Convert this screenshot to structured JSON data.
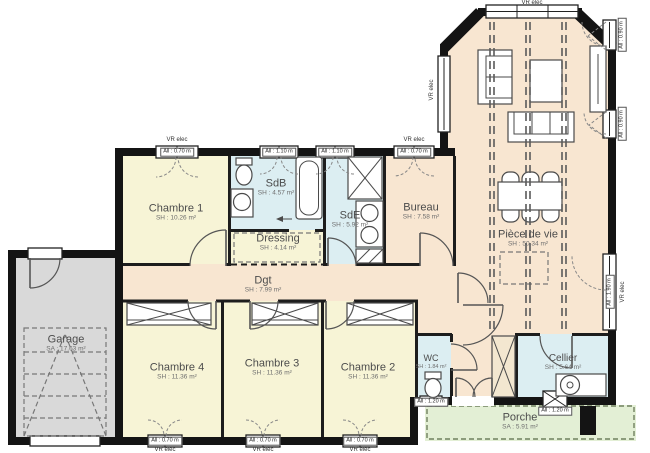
{
  "plan_title": "Plan de maison plain-pied",
  "colors": {
    "wall": "#141414",
    "bedroom_fill": "#f7f4d6",
    "wet_room_fill": "#dceef2",
    "living_fill": "#f8e6d1",
    "garage_fill": "#d9d9d9",
    "porch_fill": "#e3efd5"
  },
  "rooms": {
    "chambre1": {
      "name": "Chambre 1",
      "area": "SH : 10.26 m²"
    },
    "sdb": {
      "name": "SdB",
      "area": "SH : 4.57 m²"
    },
    "dressing": {
      "name": "Dressing",
      "area": "SH : 4.14 m²"
    },
    "sde": {
      "name": "SdE",
      "area": "SH : 5.92 m²"
    },
    "bureau": {
      "name": "Bureau",
      "area": "SH : 7.58 m²"
    },
    "piece_de_vie": {
      "name": "Pièce de vie",
      "area": "SH : 50.34 m²"
    },
    "dgt": {
      "name": "Dgt",
      "area": "SH : 7.99 m²"
    },
    "chambre4": {
      "name": "Chambre 4",
      "area": "SH : 11.36 m²"
    },
    "chambre3": {
      "name": "Chambre 3",
      "area": "SH : 11.36 m²"
    },
    "chambre2": {
      "name": "Chambre 2",
      "area": "SH : 11.36 m²"
    },
    "wc": {
      "name": "WC",
      "area": "SH : 1.84 m²"
    },
    "cellier": {
      "name": "Cellier",
      "area": "SH : 5.64 m²"
    },
    "porche": {
      "name": "Porche",
      "area": "SA : 5.91 m²"
    },
    "garage": {
      "name": "Garage",
      "area": "SA : 17.63 m²"
    }
  },
  "labels": {
    "vr": "VR elec",
    "top1": "All : 0.70 m",
    "top2": "All : 1.10 m",
    "top3": "All : 1.10 m",
    "top4": "All : 0.70 m",
    "right_up1": "All : 0.90 m",
    "right_up2": "All : 0.90 m",
    "right_low": "All : 1.90 m",
    "bottom1": "All : 0.70 m",
    "bottom2": "All : 0.70 m",
    "bottom3": "All : 0.70 m",
    "entry_side": "All : 1.20 m",
    "porch_win": "All : 1.20 m"
  }
}
